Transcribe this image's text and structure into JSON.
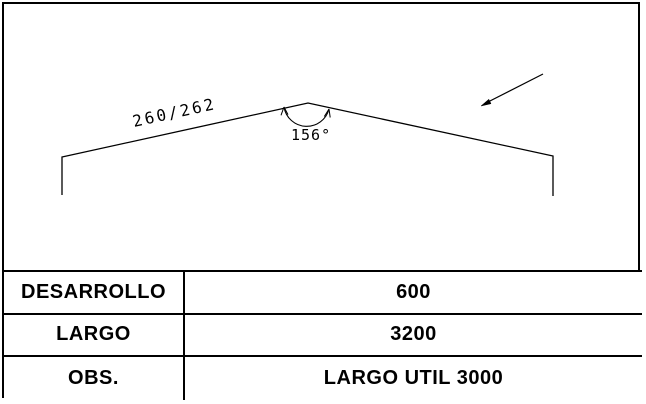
{
  "drawing": {
    "dimension_label": "260/262",
    "angle_label": "156°"
  },
  "table": {
    "rows": [
      {
        "label": "DESARROLLO",
        "value": "600"
      },
      {
        "label": "LARGO",
        "value": "3200"
      },
      {
        "label": "OBS.",
        "value": "LARGO UTIL 3000"
      }
    ]
  },
  "colors": {
    "line": "#000000",
    "background": "#ffffff"
  }
}
